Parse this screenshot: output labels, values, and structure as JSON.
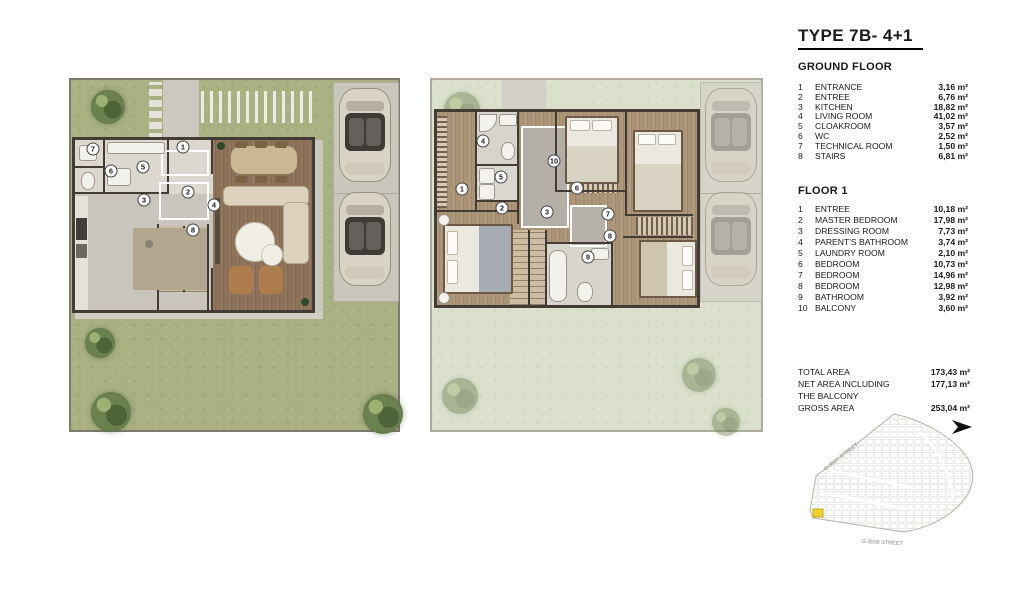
{
  "title": "TYPE 7B- 4+1",
  "ground_floor": {
    "heading": "GROUND FLOOR",
    "rooms": [
      {
        "num": "1",
        "name": "ENTRANCE",
        "area": "3,16 m²"
      },
      {
        "num": "2",
        "name": "ENTREE",
        "area": "6,76 m²"
      },
      {
        "num": "3",
        "name": "KITCHEN",
        "area": "18,82 m²"
      },
      {
        "num": "4",
        "name": "LIVING ROOM",
        "area": "41,02 m²"
      },
      {
        "num": "5",
        "name": "CLOAKROOM",
        "area": "3,57 m²"
      },
      {
        "num": "6",
        "name": "WC",
        "area": "2,52 m²"
      },
      {
        "num": "7",
        "name": "TECHNICAL ROOM",
        "area": "1,50 m²"
      },
      {
        "num": "8",
        "name": "STAIRS",
        "area": "6,81 m²"
      }
    ]
  },
  "floor_1": {
    "heading": "FLOOR 1",
    "rooms": [
      {
        "num": "1",
        "name": "ENTREE",
        "area": "10,18 m²"
      },
      {
        "num": "2",
        "name": "MASTER BEDROOM",
        "area": "17,98 m²"
      },
      {
        "num": "3",
        "name": "DRESSING ROOM",
        "area": "7,73 m²"
      },
      {
        "num": "4",
        "name": "PARENT'S BATHROOM",
        "area": "3,74 m²"
      },
      {
        "num": "5",
        "name": "LAUNDRY ROOM",
        "area": "2,10 m²"
      },
      {
        "num": "6",
        "name": "BEDROOM",
        "area": "10,73 m²"
      },
      {
        "num": "7",
        "name": "BEDROOM",
        "area": "14,96 m²"
      },
      {
        "num": "8",
        "name": "BEDROOM",
        "area": "12,98 m²"
      },
      {
        "num": "9",
        "name": "BATHROOM",
        "area": "3,92 m²"
      },
      {
        "num": "10",
        "name": "BALCONY",
        "area": "3,60 m²"
      }
    ]
  },
  "totals": [
    {
      "label": "TOTAL AREA",
      "value": "173,43 m²"
    },
    {
      "label": "NET AREA INCLUDING",
      "value": "177,13 m²"
    },
    {
      "label": "THE BALCONY",
      "value": ""
    },
    {
      "label": "GROSS AREA",
      "value": "253,04 m²"
    }
  ],
  "site_map": {
    "street_top": "G-3007 STREET",
    "street_bottom": "G-3006 STREET",
    "highlight_color": "#f2d32b"
  },
  "plans": {
    "ground": {
      "markers": [
        {
          "n": "1",
          "x": 114,
          "y": 69
        },
        {
          "n": "2",
          "x": 119,
          "y": 114
        },
        {
          "n": "3",
          "x": 75,
          "y": 122
        },
        {
          "n": "4",
          "x": 145,
          "y": 127
        },
        {
          "n": "5",
          "x": 74,
          "y": 89
        },
        {
          "n": "6",
          "x": 42,
          "y": 93
        },
        {
          "n": "7",
          "x": 24,
          "y": 71
        },
        {
          "n": "8",
          "x": 124,
          "y": 152
        }
      ]
    },
    "floor1": {
      "markers": [
        {
          "n": "1",
          "x": 32,
          "y": 111
        },
        {
          "n": "2",
          "x": 72,
          "y": 130
        },
        {
          "n": "3",
          "x": 117,
          "y": 134
        },
        {
          "n": "4",
          "x": 53,
          "y": 63
        },
        {
          "n": "5",
          "x": 71,
          "y": 99
        },
        {
          "n": "6",
          "x": 147,
          "y": 110
        },
        {
          "n": "7",
          "x": 178,
          "y": 136
        },
        {
          "n": "8",
          "x": 180,
          "y": 158
        },
        {
          "n": "9",
          "x": 158,
          "y": 179
        },
        {
          "n": "10",
          "x": 124,
          "y": 83
        }
      ]
    }
  }
}
